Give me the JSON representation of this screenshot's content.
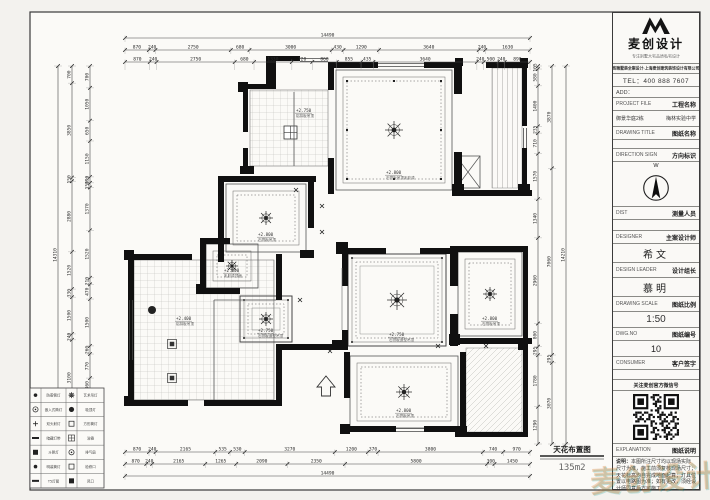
{
  "plan_title": {
    "text": "天花布置图",
    "area": "135m2"
  },
  "dimensions": {
    "top": {
      "overall": "14490",
      "row1": [
        "870",
        "240",
        "2750",
        "680",
        "3000",
        "430",
        "1290",
        "3640",
        "240",
        "1630"
      ],
      "row2": [
        "870",
        "240",
        "2750",
        "680",
        "1330",
        "720",
        "860",
        "855",
        "435",
        "3640",
        "240",
        "500",
        "240",
        "890"
      ]
    },
    "bottom": {
      "overall": "14490",
      "row1": [
        "870",
        "240",
        "2165",
        "535",
        "530",
        "3270",
        "1200",
        "370",
        "3800",
        "740",
        "970"
      ],
      "row2": [
        "870",
        "240",
        "2165",
        "1265",
        "2090",
        "2350",
        "5800",
        "300",
        "1450"
      ]
    },
    "left": {
      "overall": "14310",
      "col1": [
        "700",
        "3850",
        "150",
        "2880",
        "1520",
        "330",
        "1500",
        "240",
        "3100",
        "1150"
      ],
      "col2": [
        "700",
        "1050",
        "650",
        "1150",
        "190",
        "150",
        "1370",
        "1520",
        "210",
        "470",
        "1500",
        "260",
        "770",
        "460",
        "1150",
        "500"
      ]
    },
    "right": {
      "overall": "14210",
      "col1": [
        "105",
        "580",
        "1400",
        "235",
        "710",
        "1570",
        "1340",
        "2960",
        "800",
        "295",
        "1780",
        "1290"
      ],
      "col2": [
        "3870",
        "7060",
        "295",
        "3070"
      ]
    }
  },
  "rooms": [
    {
      "id": "kitchen",
      "elev": "+2.750",
      "note": "铝扣板吊顶"
    },
    {
      "id": "bed-top",
      "elev": "+2.800",
      "note": "石膏板吊顶乳胶漆"
    },
    {
      "id": "bed-mid-left",
      "elev": "+2.800",
      "note": "石膏板吊顶"
    },
    {
      "id": "study",
      "elev": "+2.800",
      "note": "乳胶漆顶面"
    },
    {
      "id": "dining",
      "elev": "+2.750",
      "note": "石膏板造型吊顶"
    },
    {
      "id": "living",
      "elev": "+2.750",
      "note": "石膏板造型吊顶"
    },
    {
      "id": "bed-right",
      "elev": "+2.800",
      "note": "石膏板吊顶"
    },
    {
      "id": "bed-bottom",
      "elev": "+2.800",
      "note": "石膏板吊顶"
    },
    {
      "id": "bath",
      "elev": "+2.400",
      "note": "铝扣板吊顶"
    }
  ],
  "legend": {
    "rows": [
      {
        "s1": "dot",
        "t1": "防雾筒灯",
        "s2": "star",
        "t2": "艺术吊灯"
      },
      {
        "s1": "circle",
        "t1": "嵌入式筒灯",
        "s2": "fdot",
        "t2": "吸顶灯"
      },
      {
        "s1": "cross",
        "t1": "双头射灯",
        "s2": "square",
        "t2": "方形筒灯"
      },
      {
        "s1": "bar",
        "t1": "暗藏灯带",
        "s2": "gridsq",
        "t2": "浴霸"
      },
      {
        "s1": "fsquare",
        "t1": "斗胆灯",
        "s2": "circle",
        "t2": "排气扇"
      },
      {
        "s1": "dot",
        "t1": "明装筒灯",
        "s2": "square",
        "t2": "检修口"
      },
      {
        "s1": "bar",
        "t1": "T5灯管",
        "s2": "fsquare",
        "t2": "风口"
      }
    ]
  },
  "titleblock": {
    "brand": {
      "name": "麦创设计",
      "slogan": "专注别墅大宅品质私宅设计",
      "banner": "高端墅装全案设计·上海麦创建筑装饰设计有限公司"
    },
    "tel": "TEL：400 888 7607",
    "add": "ADD：",
    "rows": {
      "project_file_en": "PROJECT FILE",
      "project_file_cn": "工程名称",
      "project_left": "御景华庭2栋",
      "project_right": "梅林实验中学",
      "drawing_title_en": "DRAWING TITLE",
      "drawing_title_cn": "图纸名称",
      "direction_en": "DIRECTION SIGN",
      "direction_cn": "方向标识",
      "compass_letter": "W",
      "dist_en": "DIST",
      "dist_cn": "测量人员",
      "designer_en": "DESIGNER",
      "designer_cn": "主案设计师",
      "designer_value": "希文",
      "leader_en": "DESIGN LEADER",
      "leader_cn": "设计组长",
      "leader_value": "慕明",
      "scale_en": "DRAWING SCALE",
      "scale_cn": "图纸比例",
      "scale_value": "1:50",
      "dwg_en": "DWG.NO",
      "dwg_cn": "图纸编号",
      "dwg_value": "10",
      "consumer_en": "CONSUMER",
      "consumer_cn": "客户签字",
      "wechat": "关注麦创官方微信号",
      "explain_en": "EXPLANATION",
      "explain_cn": "图纸说明",
      "note_title": "说明：",
      "note_body": "本图所注尺寸均以现场实际尺寸为准，施工前须复核现场尺寸；天花标高均自完成地面起算；灯具位置以电路图为准；如有更改，须经设计师同意后方可施工。",
      "remark": "备注："
    }
  },
  "watermark": "麦创设计"
}
